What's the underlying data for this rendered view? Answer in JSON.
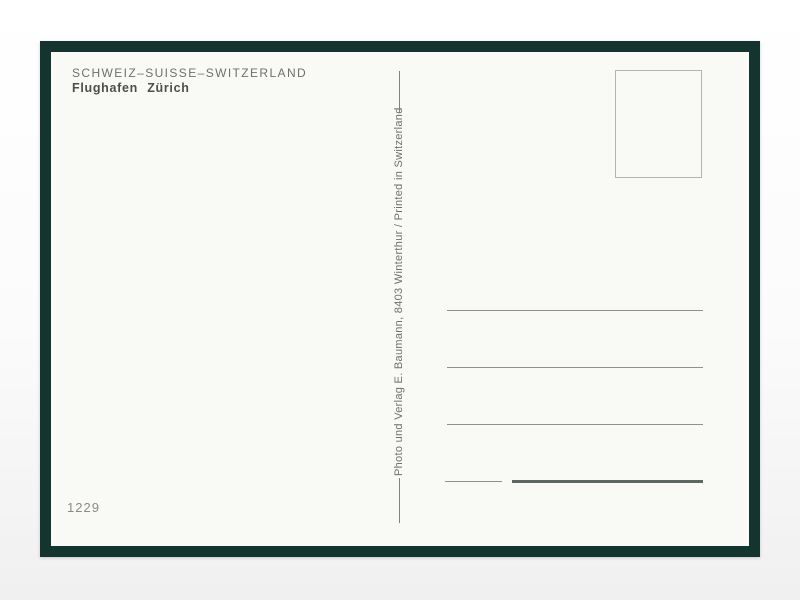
{
  "postcard": {
    "header": {
      "country_line": "SCHWEIZ–SUISSE–SWITZERLAND",
      "title": "Flughafen Zürich"
    },
    "publisher_line": "Photo und Verlag E. Baumann, 8403 Winterthur / Printed in Switzerland",
    "card_number": "1229",
    "address_lines_count": 4
  },
  "colors": {
    "frame_color": "#143430",
    "card_bg": "#f9f9f6",
    "text_gray": "#6f6f6f",
    "title_gray": "#4e4e4e",
    "dash_gray": "#7c8480",
    "line_gray": "#8f918f",
    "thick_line": "#5c6662",
    "stamp_border": "#b4b4b4",
    "number_gray": "#8a8a8a"
  }
}
